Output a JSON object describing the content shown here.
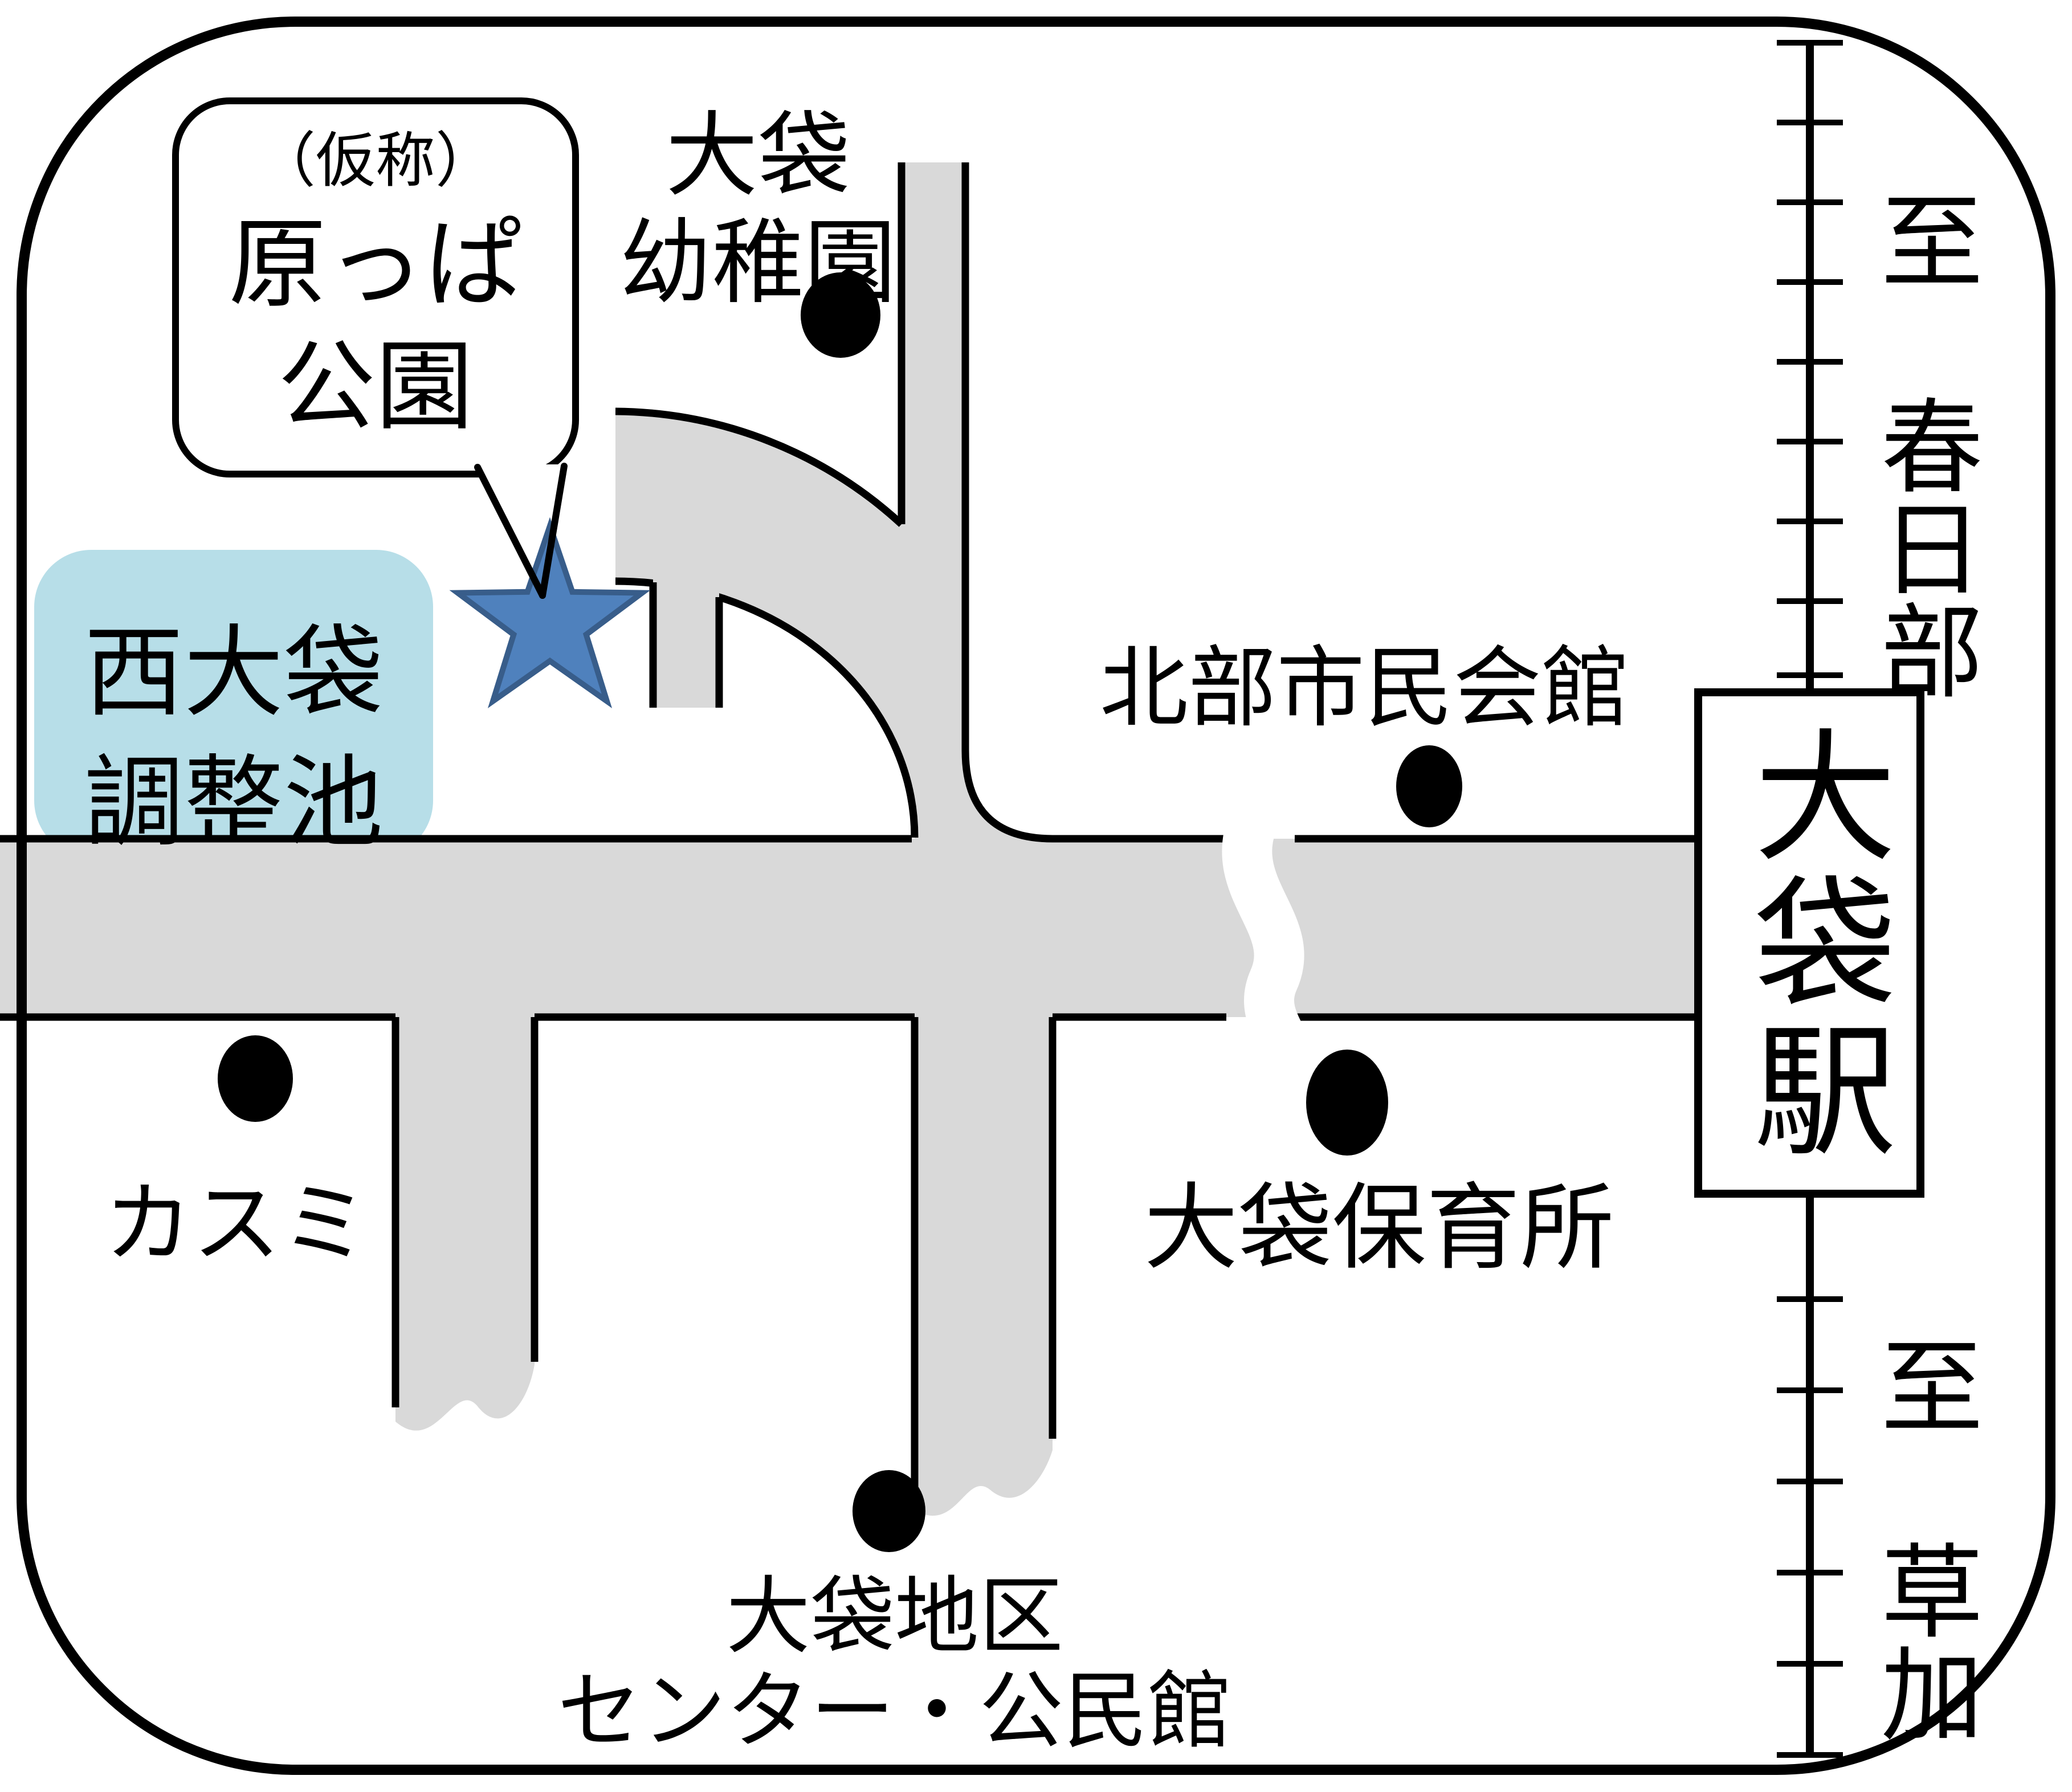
{
  "map": {
    "type": "neighborhood-access-map",
    "bubble": {
      "line1": "（仮称）",
      "line2": "原っぱ",
      "line3": "公園"
    },
    "pond_label": "西大袋\n調整池",
    "pois": [
      {
        "id": "kindergarten",
        "label": "大袋\n幼稚園"
      },
      {
        "id": "citizens-hall",
        "label": "北部市民会館"
      },
      {
        "id": "kasumi",
        "label": "カスミ"
      },
      {
        "id": "nursery",
        "label": "大袋保育所"
      },
      {
        "id": "district-center",
        "label": "大袋地区\nセンター・公民館"
      }
    ],
    "labels": {
      "kindergarten": "大袋\n幼稚園",
      "citizens_hall": "北部市民会館",
      "kasumi": "カスミ",
      "nursery": "大袋保育所",
      "district_center": "大袋地区\nセンター・公民館",
      "station": "大袋駅",
      "rail_north": "至　春日部",
      "rail_south": "至　草加"
    },
    "colors": {
      "road_fill": "#d9d9d9",
      "road_edge": "#000000",
      "pond_box_fill": "#b7dee8",
      "star_fill": "#4f81bd",
      "star_stroke": "#385d8a",
      "background": "#ffffff"
    }
  }
}
